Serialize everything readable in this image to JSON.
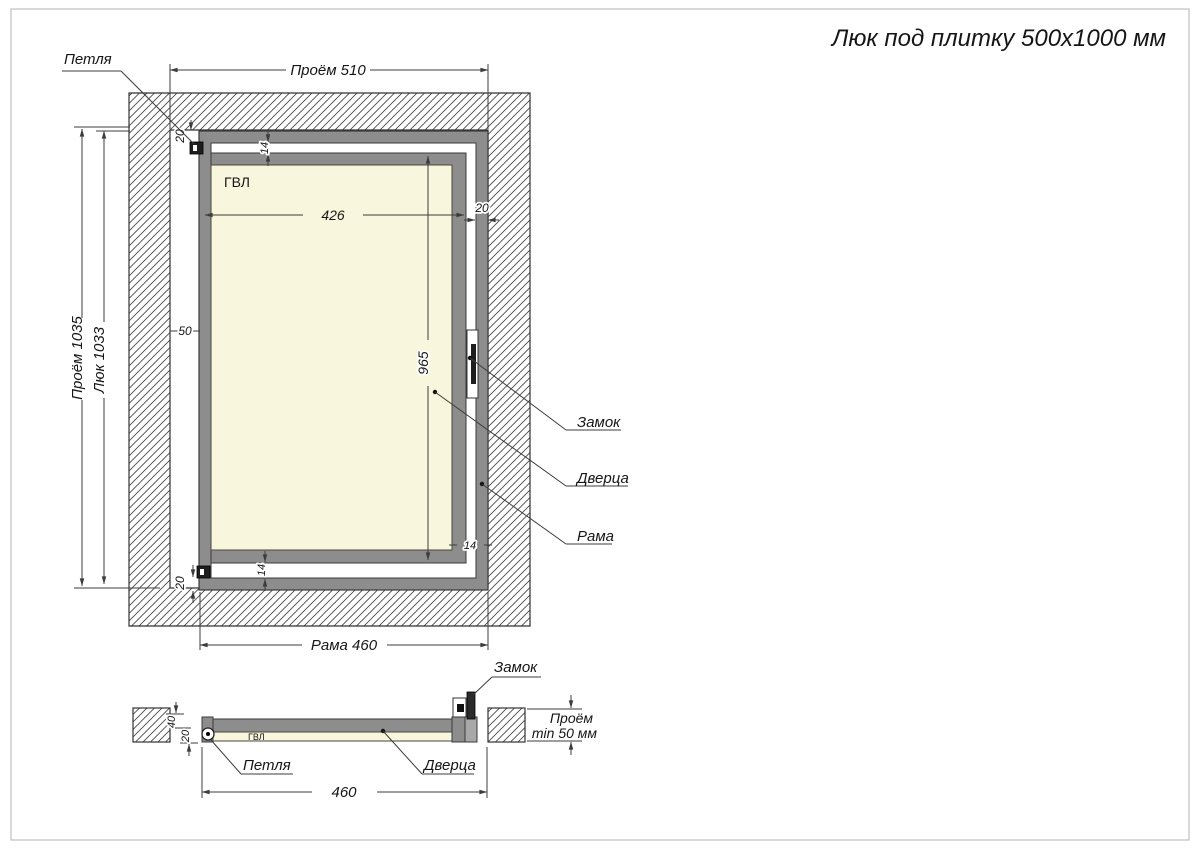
{
  "title": "Люк под плитку 500х1000 мм",
  "front": {
    "opening_width": "Проём 510",
    "opening_height": "Проём 1035",
    "hatch_height": "Люк 1033",
    "frame_width": "Рама 460",
    "board_label": "ГВЛ",
    "door_width": "426",
    "door_height": "965",
    "gap_top": "14",
    "gap_bottom": "14",
    "gap_right": "14",
    "profile_top": "20",
    "profile_right": "20",
    "profile_bottom": "20",
    "hinge_side_gap": "50",
    "hinge_label": "Петля",
    "lock_label": "Замок",
    "door_label": "Дверца",
    "frame_label": "Рама"
  },
  "section": {
    "width": "460",
    "board_label": "ГВЛ",
    "lock_label": "Замок",
    "hinge_label": "Петля",
    "door_label": "Дверца",
    "depth_total": "40",
    "depth_board": "20",
    "opening_depth_line1": "Проём",
    "opening_depth_line2": "min 50 мм"
  },
  "colors": {
    "frame_gray": "#8d8d8d",
    "profile_light_gray": "#a8a8a8",
    "board_cream": "#f8f6dd",
    "line_dark": "#3c3c3c",
    "lock_dark": "#1e1e1e"
  }
}
